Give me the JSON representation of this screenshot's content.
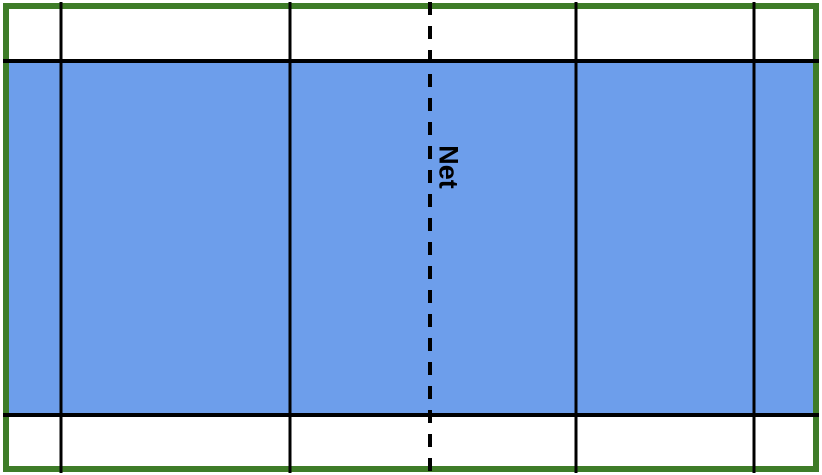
{
  "labels": {
    "net": "Net"
  },
  "colors": {
    "background": "#ffffff",
    "court_fill": "#6d9eeb",
    "boundary": "#3e7c28",
    "line": "#000000"
  },
  "court": {
    "solid_vertical_lines_x": [
      61,
      290,
      576,
      754
    ],
    "net_line_x": 430,
    "court_top_y": 61,
    "court_bottom_y": 415
  }
}
